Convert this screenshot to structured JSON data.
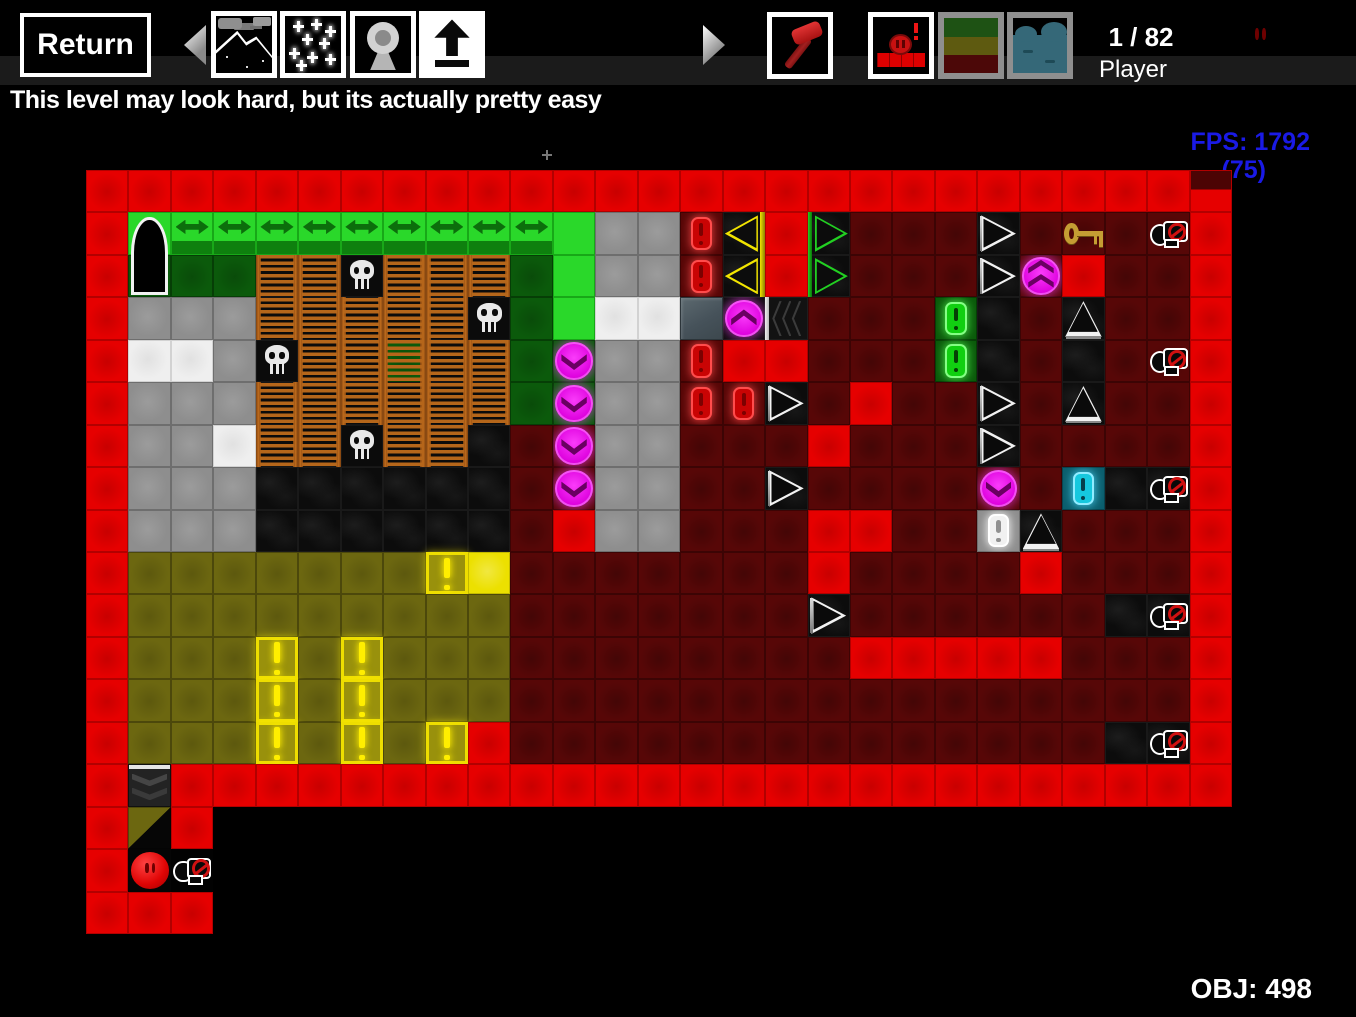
{
  "toolbar": {
    "return_label": "Return",
    "level_counter": "1 / 82",
    "selected_object_label": "Player",
    "icons": [
      "nav-left-icon",
      "preview-night-icon",
      "preview-stars-icon",
      "preview-camera-icon",
      "upload-arrow-icon",
      "nav-right-icon",
      "hammer-tool-icon",
      "player-block-tool-icon",
      "terrain-layers-tool-icon",
      "water-tool-icon",
      "player-ball-icon"
    ]
  },
  "hint": {
    "text": "This level may look hard, but its actually pretty easy"
  },
  "hud": {
    "fps": "FPS: 1792",
    "fps_note": "(75)",
    "objects": "OBJ: 498"
  },
  "colors": {
    "red": "#e60000",
    "dark_red": "#570707",
    "lime": "#2ad82a",
    "dark_green": "#0b5a0b",
    "gray": "#8e8e8e",
    "white_tile": "#efefef",
    "olive": "#6c6710",
    "yellow": "#ffee00",
    "magenta": "#ee10ee",
    "cyan": "#16c8de",
    "ladder_brown": "#c06c1c",
    "key_gold": "#c59d33",
    "fps_blue": "#1a1ae6"
  },
  "level": {
    "cols": 27,
    "rows": 18,
    "legend": {
      "R": "red-block",
      "T": "red-block-darktop",
      "r": "dark-red-block",
      "G": "lime-block",
      "A": "conveyor-arrow",
      "g": "dark-green-block",
      "1": "door-top",
      "2": "door-bottom",
      "Y": "gray-block",
      "W": "white-block",
      "L": "ladder",
      "M": "ladder-green",
      "K": "skull-block",
      "C": "cave-block",
      "O": "olive-block",
      "!": "yellow-exclaim",
      "B": "yellow-bright-block",
      "E": "red-exclaim",
      "F": "green-exclaim",
      "Q": "cyan-exclaim",
      "N": "white-exclaim",
      "<": "spike-left-yellow",
      ">": "spike-right-green",
      "w": "arrow-right-white",
      "u": "arrow-up-white",
      "d": "teleport-down-green",
      "D": "teleport-down-red",
      "U": "teleport-up",
      "^": "teleport-double-up",
      "S": "slate-block",
      "X": "ripple-door",
      "k": "key",
      "b": "bomb-dispenser-red",
      "c": "bomb-dispenser-cave",
      "v": "bomb-dispenser-dark",
      "H": "crusher-chevron",
      "/": "olive-diagonal",
      "P": "player-ball",
      ".": "void"
    },
    "map": [
      "RRRRRRRRRRRRRRRRRRRRRRRRRRT",
      "R1AAAAAAAAAGYYE<R>rrrwrkrbR",
      "R2ggLLKLLLgGYYE<R>rrrw^RrrR",
      "RYYYLLLLLKgGWWSUXrrrFCrurrR",
      "RWWYKLLMLLgdYYERRrrrFCrCrbR",
      "RYYYLLLLLLgdYYEEwrRrrwrurrR",
      "RYYWLLKLLCrDYYrrrRrrrwrrrrR",
      "RYYYCCCCCCrDYYrrwrrrrDrQCcR",
      "RYYYCCCCCCrRYYrrrRRrrNurrrR",
      "ROOOOOOO!BrrrrrrrRrrrrRrrrR",
      "ROOOOOOOOOrrrrrrrwrrrrrrCcR",
      "ROOO!O!OOOrrrrrrrrRRRRRrrrR",
      "ROOO!O!OOOrrrrrrrrrrrrrrrrR",
      "ROOO!O!O!RrrrrrrrrrrrrrrCcR",
      "RHRRRRRRRRRRRRRRRRRRRRRRRRR",
      "R/R........................",
      "RPv........................",
      "RRR........................"
    ]
  }
}
